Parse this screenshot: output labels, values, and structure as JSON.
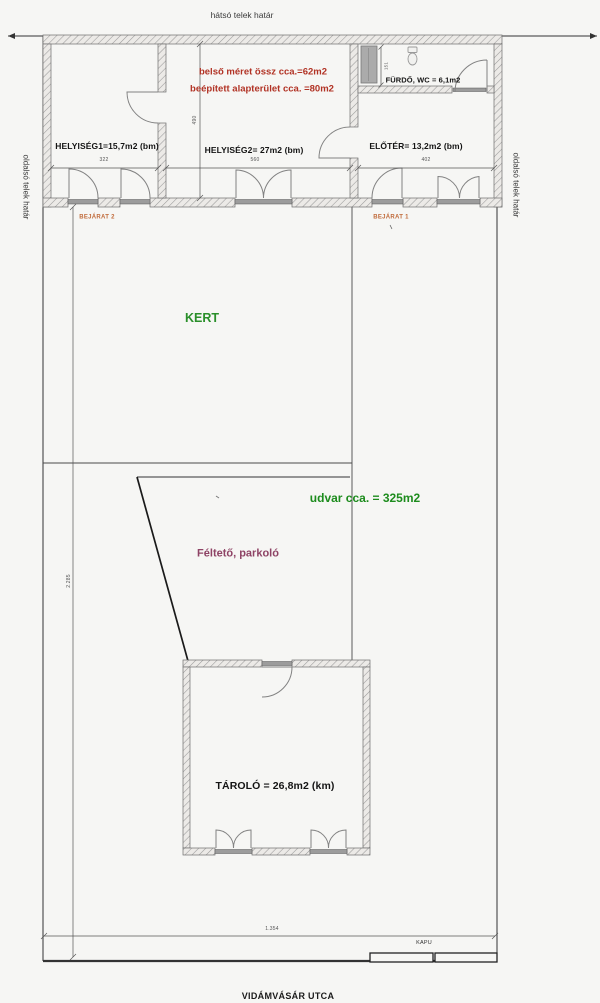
{
  "boundaries": {
    "back": "hátsó telek határ",
    "side_left": "oldalsó telek határ",
    "side_right": "oldalsó telek határ",
    "street": "VIDÁMVÁSÁR UTCA",
    "gate": "KAPU"
  },
  "notes": {
    "interior_size": "belső méret össz cca.=62m2",
    "built_area": "beépített alapterület cca. =80m2"
  },
  "rooms": {
    "helyiseg1": "HELYISÉG1=15,7m2 (bm)",
    "helyiseg2": "HELYISÉG2= 27m2 (bm)",
    "eloter": "ELŐTÉR= 13,2m2 (bm)",
    "furdo": "FÜRDŐ, WC = 6,1m2",
    "tarolo": "TÁROLÓ = 26,8m2 (km)"
  },
  "areas": {
    "garden": "KERT",
    "yard": "udvar cca. = 325m2",
    "carport": "Féltető, parkoló"
  },
  "entrances": {
    "bejarat1": "BEJÁRAT 1",
    "bejarat2": "BEJÁRAT 2"
  },
  "dimensions": {
    "room1_width": "322",
    "room2_width": "560",
    "eloter_width": "402",
    "room_depth": "490",
    "bath_depth": "151",
    "plot_depth": "2.285",
    "plot_width": "1.354"
  },
  "colors": {
    "note_red": "#b13224",
    "garden_green": "#2a8f2a",
    "yard_green": "#1d8c1d",
    "carport_purple": "#8e4365",
    "entrance_orange": "#c06a3a",
    "wall_gray": "#9a9a9a",
    "background": "#f6f6f4"
  }
}
